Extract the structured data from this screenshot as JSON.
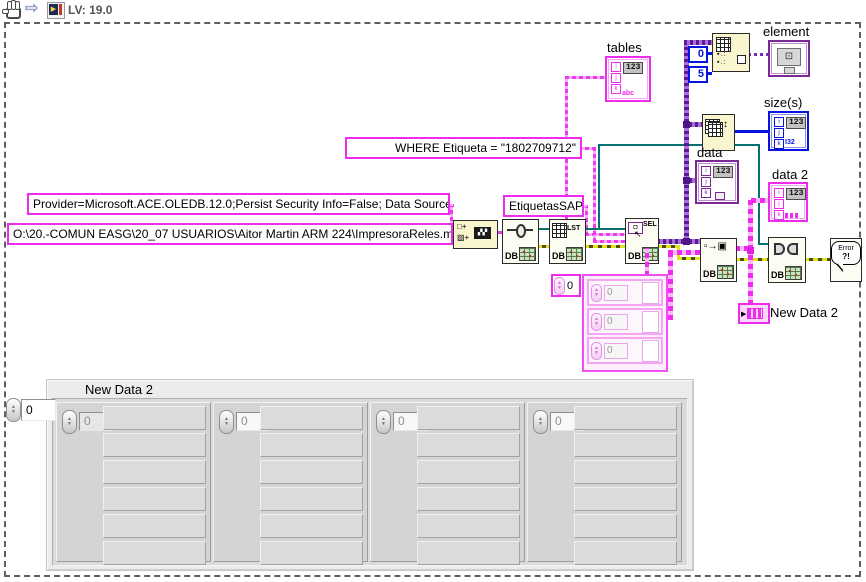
{
  "toolbar": {
    "version": "LV: 19.0"
  },
  "constants": {
    "provider": "Provider=Microsoft.ACE.OLEDB.12.0;Persist Security Info=False; Data Source=",
    "db_path": "O:\\20.-COMUN EASG\\20_07 USUARIOS\\Aitor Martin ARM 224\\ImpresoraReles.mdb",
    "where_clause": "WHERE  Etiqueta = \"1802709712\"",
    "table_name": "EtiquetasSAP",
    "index_0": "0",
    "index_5": "5",
    "cluster_index": "0",
    "cluster_value": "0"
  },
  "labels": {
    "tables": "tables",
    "element": "element",
    "sizes": "size(s)",
    "data": "data",
    "data2": "data 2",
    "new_data2": "New Data 2"
  },
  "glyphs": {
    "i": "i",
    "j": "j",
    "k": "k",
    "num": "123",
    "str": "abc",
    "int": "I32",
    "db": "DB",
    "lst": "LST",
    "sel": "SEL",
    "sel_arrow": "↖",
    "concat1": "□+",
    "concat2": "▨+",
    "v2d": "▫→▣",
    "resize": "↕",
    "error1": "Error",
    "error2": "?!",
    "term": "▶",
    "elem": "⊡",
    "up": "▲",
    "down": "▼"
  },
  "panel": {
    "title": "New Data 2",
    "index": "0",
    "value": "0"
  }
}
